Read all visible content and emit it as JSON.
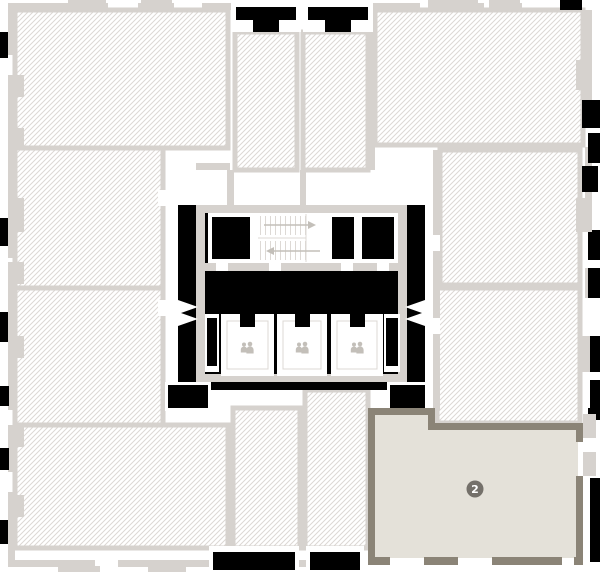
{
  "floor_plan": {
    "units": [
      {
        "id": "top-left",
        "status": "unavailable"
      },
      {
        "id": "left-middle",
        "status": "unavailable"
      },
      {
        "id": "left-lower",
        "status": "unavailable"
      },
      {
        "id": "bottom-left",
        "status": "unavailable"
      },
      {
        "id": "top-center-1",
        "status": "unavailable"
      },
      {
        "id": "top-center-2",
        "status": "unavailable"
      },
      {
        "id": "top-right",
        "status": "unavailable"
      },
      {
        "id": "right-middle",
        "status": "unavailable"
      },
      {
        "id": "right-lower",
        "status": "unavailable"
      },
      {
        "id": "bottom-center-1",
        "status": "unavailable"
      },
      {
        "id": "bottom-center-2",
        "status": "unavailable"
      },
      {
        "id": "bottom-right",
        "status": "selected",
        "badge": "2"
      }
    ],
    "core": {
      "elevator_count": 3,
      "elevator_icon": "elevator-passengers-icon",
      "stairwell": true
    }
  },
  "colors": {
    "background": "#ffffff",
    "hatch-line": "#dcd8d4",
    "wall-light": "#d6d2ce",
    "wall-dark": "#8b8477",
    "selected-fill": "#e4e1d9",
    "badge-bg": "#74706a",
    "badge-text": "#ffffff",
    "void": "#000000",
    "icon-gray": "#c3bfb9",
    "step-line": "#ddd9d5"
  }
}
